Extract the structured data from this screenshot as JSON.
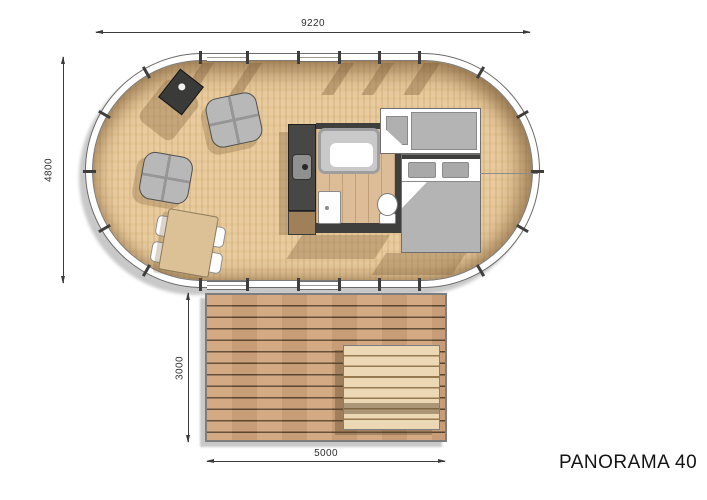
{
  "drawing": {
    "title": "PANORAMA 40",
    "type": "floor plan – oval glamping tent with deck",
    "dimensions": {
      "tent_width": "9220",
      "tent_depth": "4800",
      "deck_depth": "3000",
      "deck_width": "5000"
    },
    "rooms": [
      "living-lounge",
      "dining-area",
      "kitchen",
      "bathroom",
      "bedroom",
      "outdoor-deck"
    ],
    "furniture": [
      "wood-stove",
      "armchair",
      "armchair",
      "dining-table",
      "dining-chairs",
      "kitchen-counter-with-sink",
      "shower",
      "washbasin",
      "toilet",
      "single-bed",
      "double-bed",
      "picnic-table"
    ],
    "colors": {
      "floor_wood": "#e8cb9e",
      "interior_shadow": "#7a5a34",
      "wall_band": "#ffffff",
      "outline": "#6a6a6a",
      "kitchen_counter": "#474745",
      "furniture_gray": "#b4b4b4",
      "bath_floor": "#dcbd97",
      "deck_wood": "#d2a57e",
      "deck_gap": "#5e4930",
      "picnic_wood": "#ecd8b4",
      "drop_shadow": "#c8c8c8",
      "dimension_line": "#3c3c3c"
    }
  }
}
